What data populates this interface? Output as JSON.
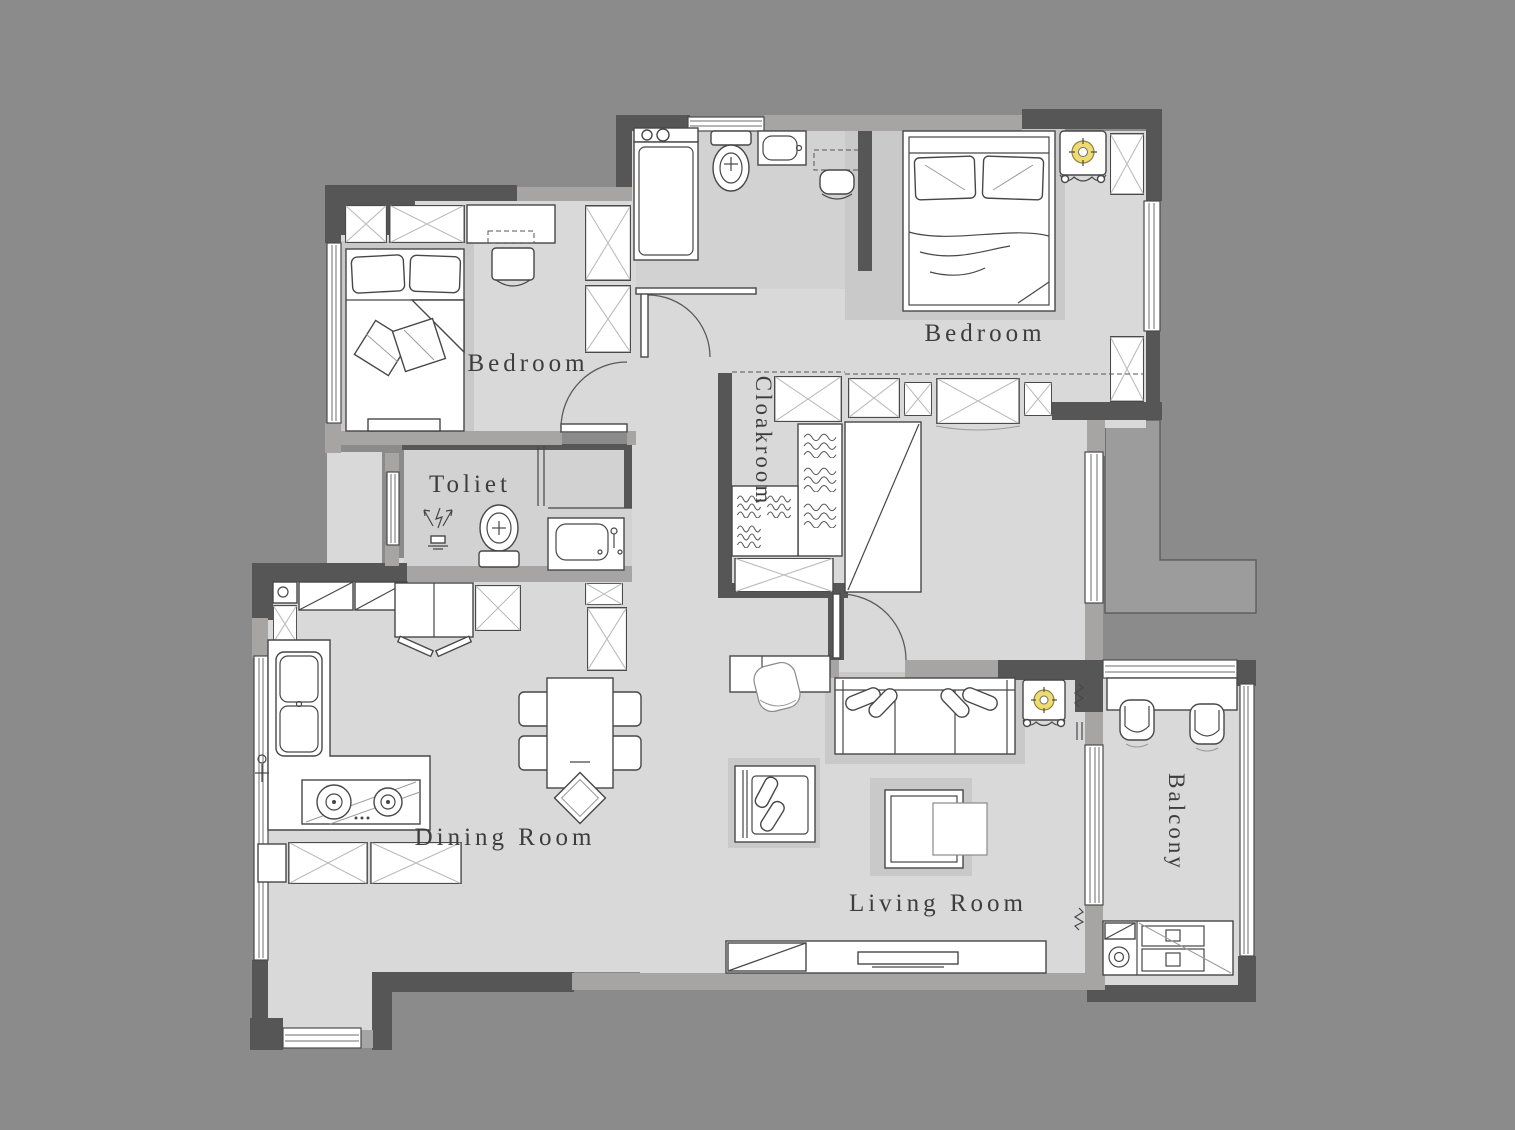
{
  "plan": {
    "type": "residential-floor-plan",
    "rooms": [
      {
        "id": "bedroom-left",
        "label": "Bedroom",
        "orientation": "horizontal"
      },
      {
        "id": "bedroom-right",
        "label": "Bedroom",
        "orientation": "horizontal"
      },
      {
        "id": "toilet",
        "label": "Toliet",
        "orientation": "horizontal"
      },
      {
        "id": "cloakroom",
        "label": "Cloakroom",
        "orientation": "vertical"
      },
      {
        "id": "dining-room",
        "label": "Dining Room",
        "orientation": "horizontal"
      },
      {
        "id": "living-room",
        "label": "Living Room",
        "orientation": "horizontal"
      },
      {
        "id": "balcony",
        "label": "Balcony",
        "orientation": "vertical"
      }
    ],
    "colors": {
      "background": "#8b8b8b",
      "floor": "#d9d9d9",
      "wet_room_floor": "#d2d2d2",
      "furniture_shadow": "#c9c9c9",
      "wall_dark": "#565656",
      "wall_medium": "#a7a4a4",
      "outline": "#474747",
      "furniture_fill": "#ffffff",
      "cross_hatch": "#bcbcbc",
      "lamp_yellow": "#eedc72",
      "outdoor_ledge": "#9c9c9c",
      "label_ink": "#3d3d3d"
    },
    "fixtures": {
      "bedroom_left": [
        "wardrobe-icon",
        "dresser-icon",
        "desk-chair-icon",
        "tall-cabinet-icon",
        "double-bed-icon",
        "pillow-icon",
        "bench-icon",
        "window-icon",
        "door-icon"
      ],
      "bathroom_top": [
        "washing-machine-icon",
        "toilet-icon",
        "sink-icon",
        "dressing-table-icon",
        "stool-icon",
        "window-icon"
      ],
      "bedroom_right": [
        "double-bed-icon",
        "nightstand-icon",
        "table-lamp-icon",
        "wardrobe-row-icon",
        "corner-cabinet-icon",
        "window-icon",
        "door-icon"
      ],
      "cloakroom": [
        "wardrobe-icon",
        "clothes-shelf-icon",
        "mirror-cabinet-icon"
      ],
      "toilet": [
        "shower-icon",
        "toilet-icon",
        "vanity-sink-icon",
        "sliding-door-icon",
        "window-icon"
      ],
      "kitchen_dining": [
        "upper-cabinet-icon",
        "fridge-icon",
        "counter-icon",
        "kitchen-sink-icon",
        "stove-icon",
        "base-cabinet-icon",
        "dining-table-icon",
        "dining-chair-icon",
        "decor-diamond-icon",
        "window-icon"
      ],
      "living_room": [
        "console-icon",
        "desk-chair-icon",
        "sofa-icon",
        "side-table-icon",
        "table-lamp-icon",
        "armchair-icon",
        "coffee-table-icon",
        "nesting-table-icon",
        "tv-bench-icon",
        "tv-icon"
      ],
      "balcony": [
        "outdoor-chair-icon",
        "balcony-bench-icon",
        "washer-cabinet-icon",
        "sliding-door-icon",
        "railing-window-icon"
      ]
    }
  }
}
